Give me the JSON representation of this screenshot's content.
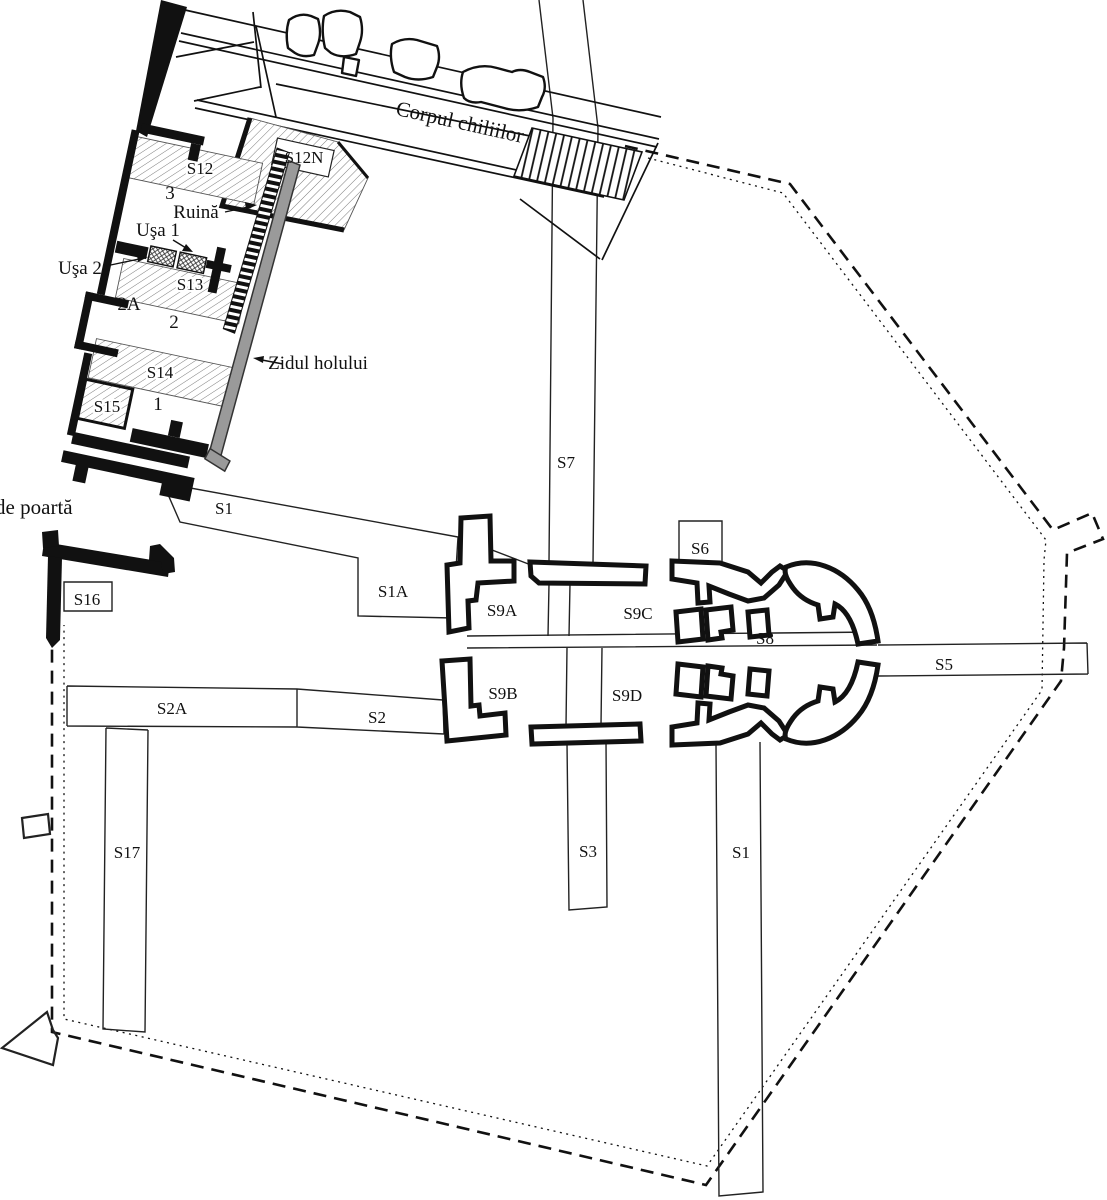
{
  "plan": {
    "annotations": {
      "cells_building": "Corpul chiliilor",
      "gate_tower": "Turnul de poartă",
      "ruin": "Ruină",
      "door_1": "Uşa 1",
      "door_2": "Uşa 2",
      "hall_wall": "Zidul holului"
    },
    "rooms": {
      "room_3": "3",
      "room_2a": "2A",
      "room_2": "2",
      "room_1": "1"
    },
    "trenches": {
      "s1_upper": "S1",
      "s1a": "S1A",
      "s1_lower": "S1",
      "s2": "S2",
      "s2a": "S2A",
      "s3": "S3",
      "s5": "S5",
      "s6": "S6",
      "s7": "S7",
      "s8": "S8",
      "s9a": "S9A",
      "s9b": "S9B",
      "s9c": "S9C",
      "s9d": "S9D",
      "s12": "S12",
      "s12n": "S12N",
      "s13": "S13",
      "s14": "S14",
      "s15": "S15",
      "s16": "S16",
      "s17": "S17"
    },
    "colors": {
      "ink": "#111111",
      "hall_wall_gray": "#9a9a9a",
      "paper": "#ffffff"
    }
  }
}
